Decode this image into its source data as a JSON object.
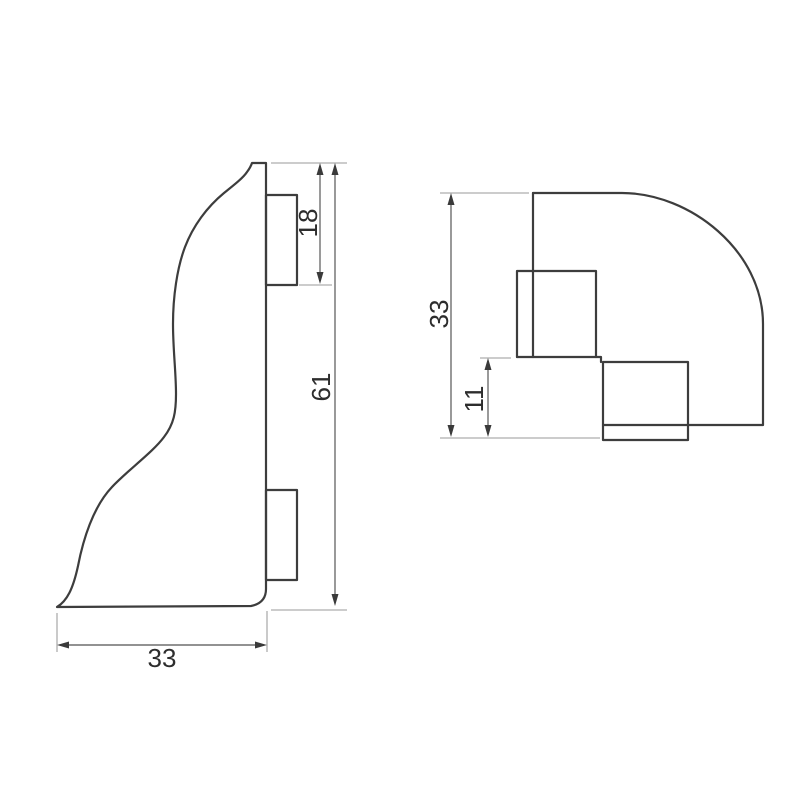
{
  "meta": {
    "drawing_type": "technical dimension drawing",
    "part": "skirting board external corner cap",
    "views_count": 2
  },
  "colors": {
    "background": "#ffffff",
    "outline": "#3d3d3d",
    "dimension_line": "#6e6e6e",
    "extension_line": "#adadad",
    "dimension_text": "#2d2d2d"
  },
  "views": {
    "side_profile": {
      "name": "side profile view",
      "dimensions": {
        "clip_height": {
          "value": "18",
          "orientation": "vertical"
        },
        "overall_height": {
          "value": "61",
          "orientation": "vertical"
        },
        "base_width": {
          "value": "33",
          "orientation": "horizontal"
        }
      }
    },
    "top_view": {
      "name": "top plan view",
      "dimensions": {
        "overall_depth": {
          "value": "33",
          "orientation": "vertical"
        },
        "clip_offset": {
          "value": "11",
          "orientation": "vertical"
        }
      }
    }
  }
}
